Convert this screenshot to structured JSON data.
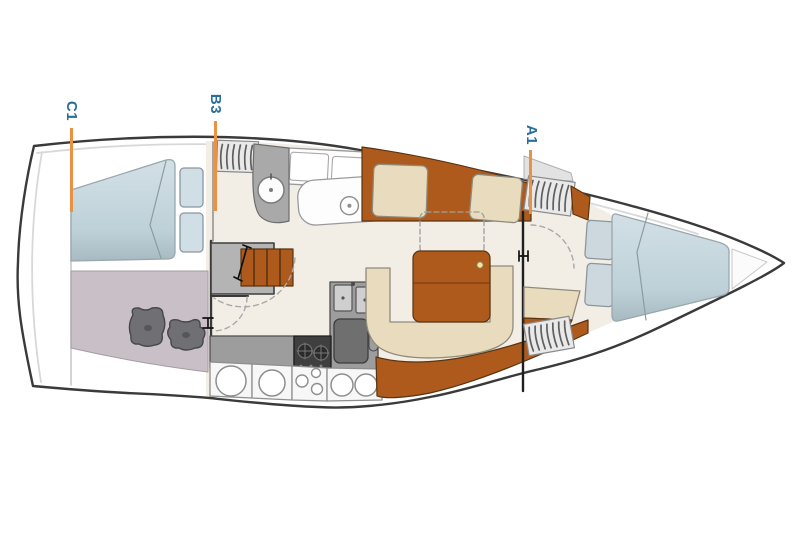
{
  "diagram": {
    "kind": "sailboat-interior-floorplan",
    "orientation": "bow-right",
    "section_labels": [
      {
        "id": "c1",
        "text": "C1"
      },
      {
        "id": "b3",
        "text": "B3"
      },
      {
        "id": "a1",
        "text": "A1"
      }
    ],
    "parts": [
      "aft-cabin-berth",
      "aft-storage-room",
      "companionway-steps",
      "head-vanity-sink",
      "toilet",
      "galley-counter",
      "galley-stove",
      "galley-double-sink",
      "salon-settee",
      "salon-table",
      "v-berth",
      "forward-lockers",
      "hull-outline"
    ],
    "colors": {
      "label_text": "#2a6e9d",
      "marker_line": "#eb9143",
      "hull_outline": "#3a3a3a",
      "floor": "#f2eee6",
      "wood": "#ad5a1c",
      "cushion": "#e9dcbe",
      "mattress": "#c3d6dd",
      "counter": "#9d9d9d",
      "stove": "#3f3f3f",
      "storage_room": "#c8c0c6"
    }
  }
}
